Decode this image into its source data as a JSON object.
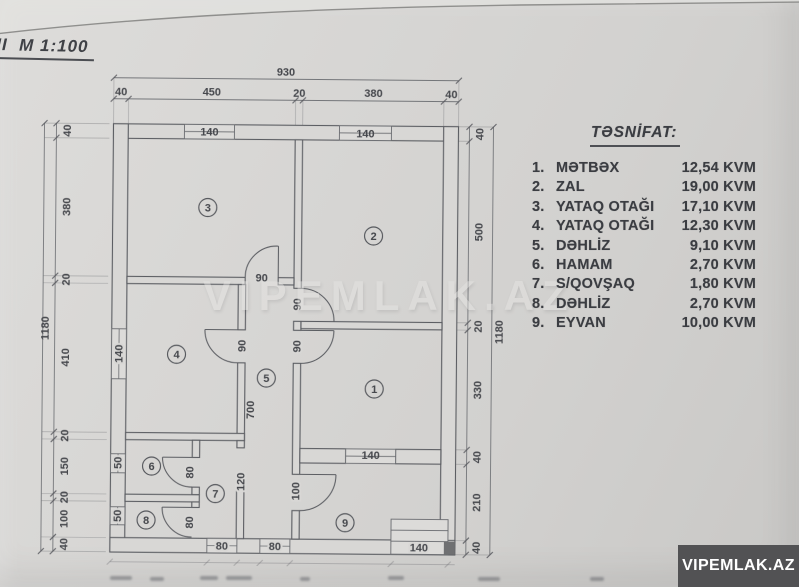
{
  "page": {
    "scale_title": "II  M 1:100",
    "watermark": "VIPEMLAK.AZ",
    "badge": "VIPEMLAK.AZ"
  },
  "legend": {
    "title": "TƏSNİFAT:",
    "items": [
      {
        "num": "1.",
        "name": "MƏTBƏX",
        "area": "12,54 KVM"
      },
      {
        "num": "2.",
        "name": "ZAL",
        "area": "19,00 KVM"
      },
      {
        "num": "3.",
        "name": "YATAQ OTAĞI",
        "area": "17,10 KVM"
      },
      {
        "num": "4.",
        "name": "YATAQ OTAĞI",
        "area": "12,30 KVM"
      },
      {
        "num": "5.",
        "name": "DƏHLİZ",
        "area": "9,10 KVM"
      },
      {
        "num": "6.",
        "name": "HAMAM",
        "area": "2,70 KVM"
      },
      {
        "num": "7.",
        "name": "S/QOVŞAQ",
        "area": "1,80 KVM"
      },
      {
        "num": "8.",
        "name": "DƏHLİZ",
        "area": "2,70 KVM"
      },
      {
        "num": "9.",
        "name": "EYVAN",
        "area": "10,00 KVM"
      }
    ]
  },
  "plan": {
    "overall": {
      "top": "930",
      "left": "1180",
      "right": "1180"
    },
    "top_segments": [
      "40",
      "450",
      "20",
      "380",
      "40"
    ],
    "left_segments": [
      "40",
      "380",
      "20",
      "410",
      "20",
      "150",
      "20",
      "100",
      "40"
    ],
    "right_segments": [
      "40",
      "500",
      "20",
      "330",
      "40",
      "210",
      "40"
    ],
    "windows": {
      "room3_top": "140",
      "room2_top": "140",
      "room4_left": "140",
      "room6_left": "50",
      "room8_left": "50",
      "room1_bottom": "140",
      "entry_steps": "140"
    },
    "doors": {
      "room3": "90",
      "room2": "90",
      "room1": "90",
      "room4": "90",
      "room6": "80",
      "room8": "80",
      "room9": "100",
      "bottom_opening_1": "80",
      "bottom_opening_2": "80"
    },
    "inner_dims": {
      "hall_length": "700",
      "wc_width": "120"
    },
    "room_numbers": [
      "1",
      "2",
      "3",
      "4",
      "5",
      "6",
      "7",
      "8",
      "9"
    ]
  }
}
